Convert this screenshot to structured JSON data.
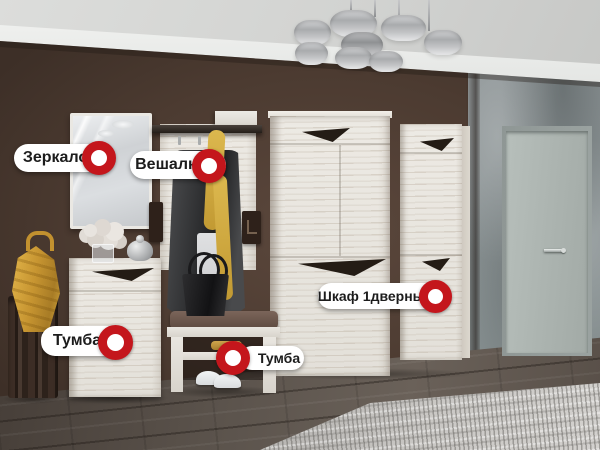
{
  "hotspot_labels": [
    {
      "id": "mirror",
      "label": "Зеркало",
      "marker_side": "right"
    },
    {
      "id": "coat-rack",
      "label": "Вешалка",
      "marker_side": "right"
    },
    {
      "id": "cabinet",
      "label": "Тумба",
      "marker_side": "right"
    },
    {
      "id": "wardrobe-1-door",
      "label": "Шкаф 1дверный",
      "marker_side": "right"
    },
    {
      "id": "bench",
      "label": "Тумба",
      "marker_side": "left"
    }
  ],
  "marker": {
    "icon": "red-donut-hotspot",
    "ring_color": "#c4161c",
    "center_color": "#ffffff"
  },
  "palette": {
    "label_background": "#ffffff",
    "label_text": "#1c1c1c",
    "wall_brown": "#4c3c33",
    "wall_gray": "#8b9294",
    "furniture_white": "#e8e5df",
    "floor_wood": "#5a524b",
    "rug_gray": "#c6c4c1",
    "accent_yellow": "#d4a942",
    "ceiling": "#d7d8d6",
    "door": "#aeb6b2"
  }
}
